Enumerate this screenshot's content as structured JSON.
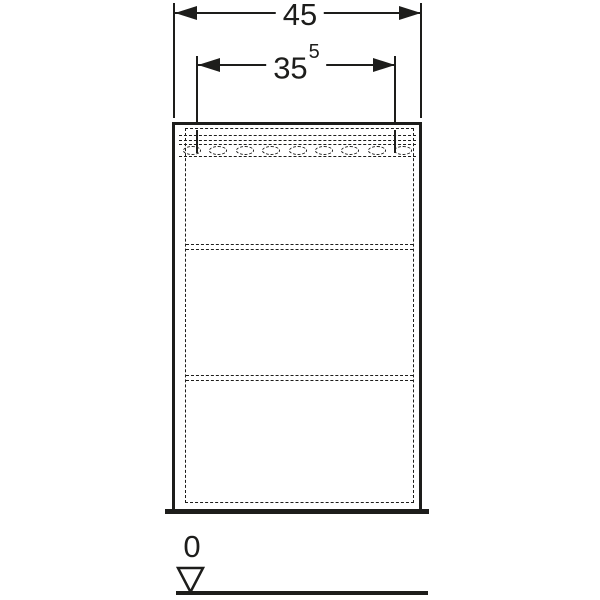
{
  "drawing": {
    "type": "technical-dimension-drawing",
    "background_color": "#ffffff",
    "line_color": "#1d1d1b",
    "dim_overall": {
      "label": "45"
    },
    "dim_inner": {
      "label": "35",
      "sup": "5"
    },
    "datum": {
      "label": "0"
    },
    "cabinet": {
      "shelf_count": 2
    },
    "perforations": {
      "count": 9
    }
  }
}
